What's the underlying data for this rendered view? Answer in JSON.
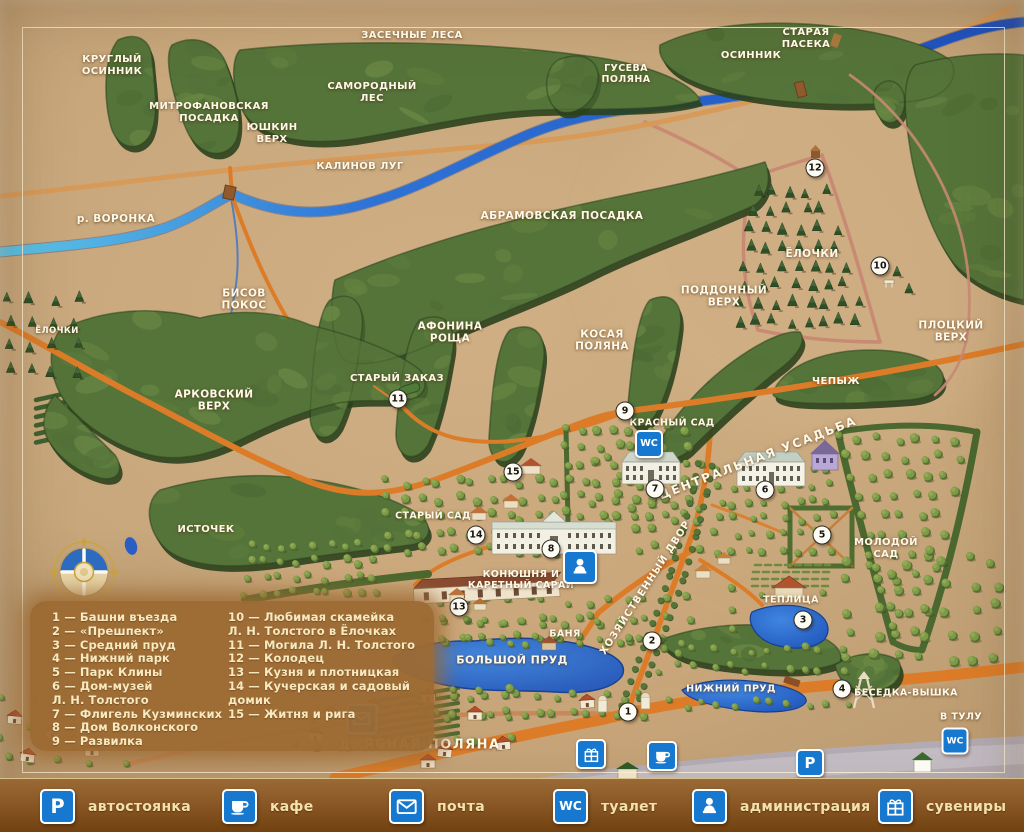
{
  "map": {
    "region_labels": [
      {
        "id": "krugly-osinnik",
        "text": "КРУГЛЫЙ\nОСИННИК",
        "x": 112,
        "y": 66,
        "size": 10
      },
      {
        "id": "zasechnye-lesa",
        "text": "ЗАСЕЧНЫЕ ЛЕСА",
        "x": 412,
        "y": 36,
        "size": 10
      },
      {
        "id": "samorodny-les",
        "text": "САМОРОДНЫЙ\nЛЕС",
        "x": 372,
        "y": 93,
        "size": 10
      },
      {
        "id": "mitrofanovskaya-posadka",
        "text": "МИТРОФАНОВСКАЯ\nПОСАДКА",
        "x": 209,
        "y": 113,
        "size": 10
      },
      {
        "id": "yushkin-verkh",
        "text": "ЮШКИН\nВЕРХ",
        "x": 272,
        "y": 134,
        "size": 10
      },
      {
        "id": "kalinov-lug",
        "text": "КАЛИНОВ ЛУГ",
        "x": 360,
        "y": 167,
        "size": 10
      },
      {
        "id": "guseva-polyana",
        "text": "ГУСЕВА\nПОЛЯНА",
        "x": 626,
        "y": 74,
        "size": 9.5
      },
      {
        "id": "osinnik",
        "text": "ОСИННИК",
        "x": 751,
        "y": 56,
        "size": 10
      },
      {
        "id": "staraya-paseka",
        "text": "СТАРАЯ\nПАСЕКА",
        "x": 806,
        "y": 39,
        "size": 10
      },
      {
        "id": "r-voronka",
        "text": "р. ВОРОНКА",
        "x": 116,
        "y": 219,
        "size": 10.5
      },
      {
        "id": "abramovskaya-posadka",
        "text": "АБРАМОВСКАЯ ПОСАДКА",
        "x": 562,
        "y": 216,
        "size": 10.5
      },
      {
        "id": "bisov-pokos",
        "text": "БИСОВ\nПОКОС",
        "x": 244,
        "y": 300,
        "size": 10.5
      },
      {
        "id": "yolochki-left",
        "text": "ЁЛОЧКИ",
        "x": 57,
        "y": 331,
        "size": 8.5
      },
      {
        "id": "yolochki",
        "text": "ЁЛОЧКИ",
        "x": 812,
        "y": 254,
        "size": 10.5
      },
      {
        "id": "poddonny-verkh",
        "text": "ПОДДОННЫЙ\nВЕРХ",
        "x": 724,
        "y": 297,
        "size": 10.5
      },
      {
        "id": "plotsky-verkh",
        "text": "ПЛОЦКИЙ\nВЕРХ",
        "x": 951,
        "y": 332,
        "size": 10.5
      },
      {
        "id": "afonina-roshcha",
        "text": "АФОНИНА\nРОЩА",
        "x": 450,
        "y": 333,
        "size": 10.5
      },
      {
        "id": "kosaya-polyana",
        "text": "КОСАЯ\nПОЛЯНА",
        "x": 602,
        "y": 341,
        "size": 10.5
      },
      {
        "id": "stary-zakaz",
        "text": "СТАРЫЙ ЗАКАЗ",
        "x": 397,
        "y": 379,
        "size": 10
      },
      {
        "id": "arkovsky-verkh",
        "text": "АРКОВСКИЙ\nВЕРХ",
        "x": 214,
        "y": 401,
        "size": 10.5
      },
      {
        "id": "chepyzh",
        "text": "ЧЕПЫЖ",
        "x": 836,
        "y": 382,
        "size": 10
      },
      {
        "id": "krasny-sad",
        "text": "КРАСНЫЙ САД",
        "x": 672,
        "y": 423,
        "size": 9.5
      },
      {
        "id": "tsentralnaya-usadba",
        "text": "ЦЕНТРАЛЬНАЯ УСАДЬБА",
        "x": 758,
        "y": 458,
        "size": 12,
        "rot": -21,
        "spacing": 2
      },
      {
        "id": "istochek",
        "text": "ИСТОЧЕК",
        "x": 206,
        "y": 530,
        "size": 10
      },
      {
        "id": "stary-sad",
        "text": "СТАРЫЙ САД",
        "x": 433,
        "y": 516,
        "size": 9.5
      },
      {
        "id": "molodoy-sad",
        "text": "МОЛОДОЙ\nСАД",
        "x": 886,
        "y": 549,
        "size": 10
      },
      {
        "id": "konyushnya",
        "text": "КОНЮШНЯ И\nКАРЕТНЫЙ САРАЙ",
        "x": 521,
        "y": 580,
        "size": 9.5
      },
      {
        "id": "khozyaystvenny-dvor",
        "text": "ХОЗЯЙСТВЕННЫЙ ДВОР",
        "x": 646,
        "y": 588,
        "size": 10,
        "rot": -57,
        "spacing": 1
      },
      {
        "id": "teplitsa",
        "text": "ТЕПЛИЦА",
        "x": 791,
        "y": 600,
        "size": 9.5
      },
      {
        "id": "banya",
        "text": "БАНЯ",
        "x": 565,
        "y": 634,
        "size": 9.5
      },
      {
        "id": "bolshoy-prud",
        "text": "БОЛЬШОЙ ПРУД",
        "x": 512,
        "y": 661,
        "size": 11
      },
      {
        "id": "nizhny-prud",
        "text": "НИЖНИЙ ПРУД",
        "x": 731,
        "y": 689,
        "size": 9.5
      },
      {
        "id": "besedka-vyshka",
        "text": "БЕСЕДКА-ВЫШКА",
        "x": 906,
        "y": 693,
        "size": 9.5
      },
      {
        "id": "v-tulu",
        "text": "В ТУЛУ",
        "x": 961,
        "y": 717,
        "size": 9.5
      },
      {
        "id": "yasnaya-polyana",
        "text": "д. ЯСНАЯ ПОЛЯНА",
        "x": 420,
        "y": 745,
        "size": 13,
        "spacing": 1.5
      }
    ],
    "markers": [
      {
        "n": "1",
        "x": 628,
        "y": 712
      },
      {
        "n": "2",
        "x": 652,
        "y": 641
      },
      {
        "n": "3",
        "x": 803,
        "y": 620
      },
      {
        "n": "4",
        "x": 842,
        "y": 689
      },
      {
        "n": "5",
        "x": 822,
        "y": 535
      },
      {
        "n": "6",
        "x": 765,
        "y": 490
      },
      {
        "n": "7",
        "x": 655,
        "y": 489
      },
      {
        "n": "8",
        "x": 551,
        "y": 549
      },
      {
        "n": "9",
        "x": 625,
        "y": 411
      },
      {
        "n": "10",
        "x": 880,
        "y": 266
      },
      {
        "n": "11",
        "x": 398,
        "y": 399
      },
      {
        "n": "12",
        "x": 815,
        "y": 168
      },
      {
        "n": "13",
        "x": 459,
        "y": 607
      },
      {
        "n": "14",
        "x": 476,
        "y": 535
      },
      {
        "n": "15",
        "x": 513,
        "y": 472
      }
    ],
    "icons": [
      {
        "type": "wc",
        "x": 649,
        "y": 444,
        "size": 24
      },
      {
        "type": "admin",
        "x": 580,
        "y": 567,
        "size": 30
      },
      {
        "type": "post",
        "x": 362,
        "y": 719,
        "size": 27
      },
      {
        "type": "gift",
        "x": 591,
        "y": 754,
        "size": 26
      },
      {
        "type": "cafe",
        "x": 662,
        "y": 756,
        "size": 26
      },
      {
        "type": "parking",
        "x": 810,
        "y": 763,
        "size": 24
      },
      {
        "type": "wc",
        "x": 955,
        "y": 741,
        "size": 23
      }
    ]
  },
  "icon_defs": {
    "parking": {
      "label": "автостоянка",
      "glyph": "P"
    },
    "cafe": {
      "label": "кафе"
    },
    "post": {
      "label": "почта"
    },
    "wc": {
      "label": "туалет",
      "glyph": "WC"
    },
    "admin": {
      "label": "администрация"
    },
    "gift": {
      "label": "сувениры"
    }
  },
  "legend_list": {
    "columns": [
      {
        "lines": [
          "1 — Башни въезда",
          "2 — «Прешпект»",
          "3 — Средний пруд",
          "4 — Нижний парк",
          "5 — Парк  Клины",
          "6 — Дом-музей",
          "Л. Н. Толстого",
          "7 — Флигель Кузминских",
          "8 — Дом Волконского",
          "9 — Развилка"
        ]
      },
      {
        "lines": [
          "10 — Любимая скамейка",
          "Л. Н. Толстого в Ёлочках",
          "11 — Могила Л. Н. Толстого",
          "12 — Колодец",
          "13 — Кузня и плотницкая",
          "14 — Кучерская и садовый",
          "домик",
          "15 — Житня и рига"
        ]
      }
    ]
  },
  "legend_bar": {
    "items": [
      "parking",
      "cafe",
      "post",
      "wc",
      "admin",
      "gift"
    ]
  },
  "colors": {
    "land": "#c9a87d",
    "forest": "#55743a",
    "water": "#2257c4",
    "road": "#dd7c28",
    "trail": "#c98a74",
    "icon_blue": "#1678cf",
    "legend_bg": "#9c6a33",
    "legend_text": "#f7e9c0"
  }
}
